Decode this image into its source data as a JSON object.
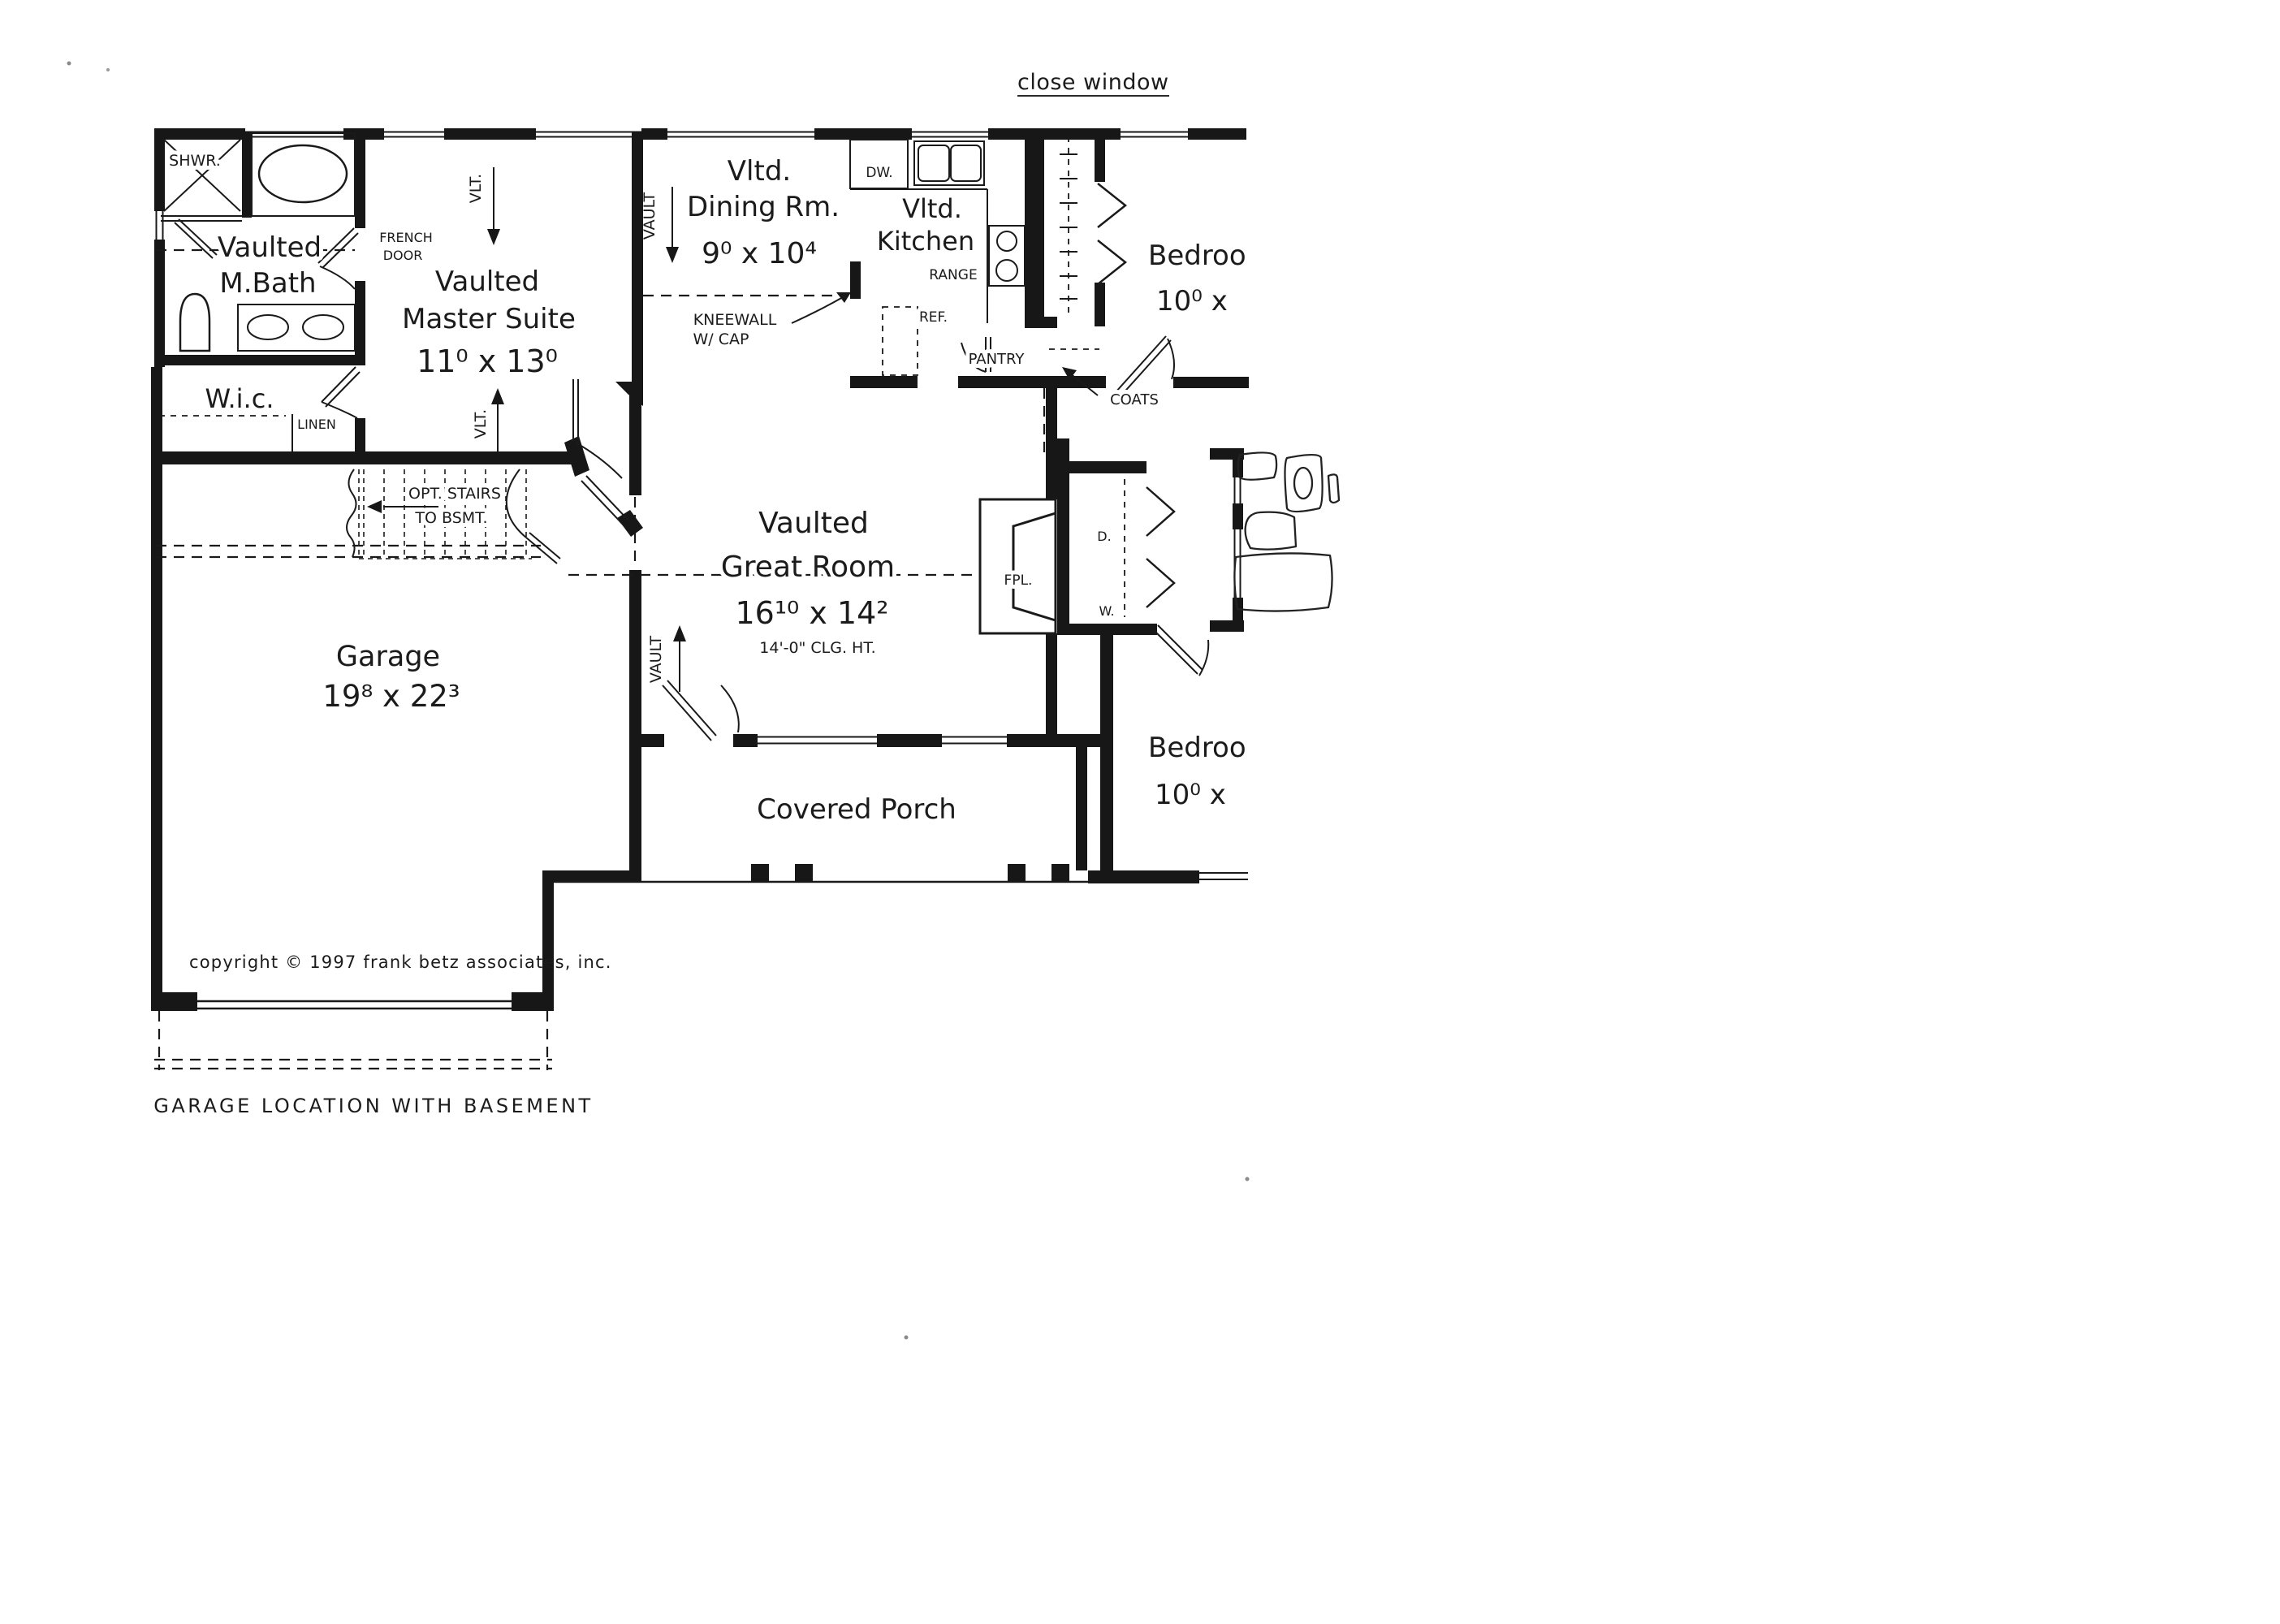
{
  "page": {
    "close_window": "close window"
  },
  "rooms": {
    "mbath": {
      "l1": "Vaulted",
      "l2": "M.Bath"
    },
    "master": {
      "l1": "Vaulted",
      "l2": "Master Suite",
      "dims": "11⁰ x 13⁰"
    },
    "wic": {
      "name": "W.i.c."
    },
    "dining": {
      "l1": "Vltd.",
      "l2": "Dining Rm.",
      "dims": "9⁰ x 10⁴"
    },
    "kitchen": {
      "l1": "Vltd.",
      "l2": "Kitchen"
    },
    "great": {
      "l1": "Vaulted",
      "l2": "Great Room",
      "dims": "16¹⁰ x 14²",
      "clg": "14'-0\" CLG. HT."
    },
    "garage": {
      "name": "Garage",
      "dims": "19⁸ x 22³"
    },
    "porch": {
      "name": "Covered Porch"
    },
    "bed1": {
      "name": "Bedroo",
      "dims": "10⁰ x"
    },
    "bed2": {
      "name": "Bedroo",
      "dims": "10⁰ x"
    }
  },
  "labels": {
    "shwr": "SHWR.",
    "french1": "FRENCH",
    "french2": "DOOR",
    "linen": "LINEN",
    "stairs1": "OPT. STAIRS",
    "stairs2": "TO BSMT.",
    "vlt": "VLT.",
    "vault": "VAULT",
    "dw": "DW.",
    "range": "RANGE",
    "ref": "REF.",
    "pantry": "PANTRY",
    "coats": "COATS",
    "kneewall1": "KNEEWALL",
    "kneewall2": "W/ CAP",
    "fpl": "FPL.",
    "dryer": "D.",
    "washer": "W."
  },
  "footer": {
    "copyright": "copyright © 1997 frank betz associates, inc.",
    "caption": "GARAGE LOCATION WITH BASEMENT"
  }
}
